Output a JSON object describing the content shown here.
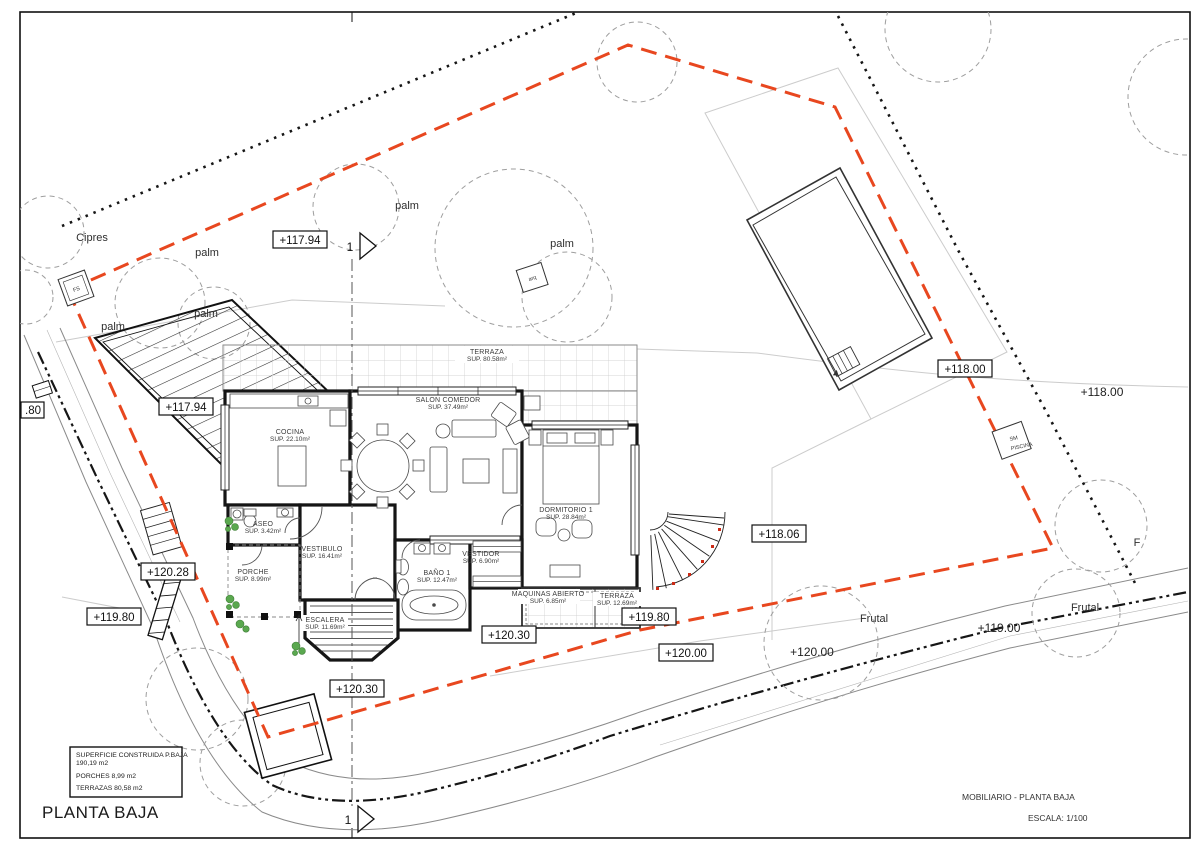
{
  "titles": {
    "plan": "PLANTA BAJA",
    "sheet": "MOBILIARIO - PLANTA BAJA",
    "scale": "ESCALA: 1/100"
  },
  "legend": {
    "line1": "SUPERFICIE CONSTRUIDA P.BAJA",
    "line1_value": "190,19 m2",
    "porches": "PORCHES   8,99 m2",
    "terrazas": "TERRAZAS  80,58 m2"
  },
  "rooms": {
    "terraza": {
      "name": "TERRAZA",
      "area": "SUP. 80.58m²"
    },
    "salon": {
      "name": "SALON COMEDOR",
      "area": "SUP. 37.49m²"
    },
    "cocina": {
      "name": "COCINA",
      "area": "SUP. 22.10m²"
    },
    "dormitorio": {
      "name": "DORMITORIO 1",
      "area": "SUP. 28.84m²"
    },
    "aseo": {
      "name": "ASEO",
      "area": "SUP. 3.42m²"
    },
    "vestibulo": {
      "name": "VESTIBULO",
      "area": "SUP. 16.41m²"
    },
    "porche": {
      "name": "PORCHE",
      "area": "SUP. 8.99m²"
    },
    "bano": {
      "name": "BAÑO 1",
      "area": "SUP. 12.47m²"
    },
    "vestidor": {
      "name": "VESTIDOR",
      "area": "SUP. 6.90m²"
    },
    "escalera": {
      "name": "ESCALERA",
      "area": "SUP. 11.69m²"
    },
    "maquinas": {
      "name": "MAQUINAS ABIERTO",
      "area": "SUP. 6.85m²"
    },
    "terraza2": {
      "name": "TERRAZA",
      "area": "SUP. 12.69m²"
    }
  },
  "elevations": {
    "e11794": "+117.94",
    "e11800": "+118.00",
    "e11806": "+118.06",
    "e11900": "+119.00",
    "e11980": "+119.80",
    "e12000": "+120.00",
    "e12028": "+120.28",
    "e12030": "+120.30",
    "clipped80": ".80"
  },
  "veg": {
    "cipres": "Cipres",
    "palm": "palm",
    "frutal": "Frutal",
    "frutal_clip": "F"
  },
  "markers": {
    "fs": "FS",
    "arq": "arq",
    "piscina_line1": "SM",
    "piscina_line2": "PISCINA",
    "section": "1"
  },
  "colors": {
    "boundary_red": "#e8471f",
    "property_black": "#161616",
    "wall_black": "#1a1a1a",
    "plant_green": "#4c9c44",
    "terrain_gray": "#cccccc"
  }
}
